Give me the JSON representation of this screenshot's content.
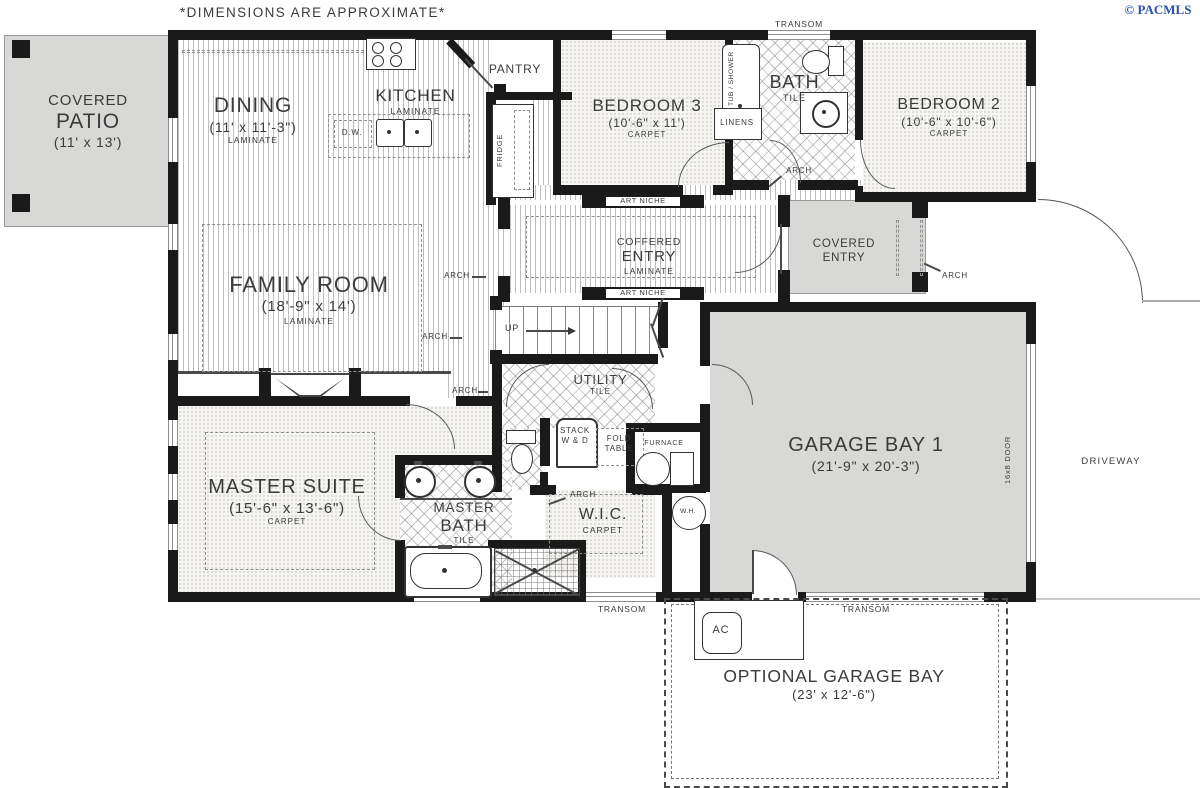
{
  "plan": {
    "disclaimer": "*DIMENSIONS ARE APPROXIMATE*",
    "copyright": "© PACMLS",
    "accent_blue": "#2d4fae",
    "rooms": {
      "covered_patio": {
        "line1": "COVERED",
        "line2": "PATIO",
        "dims": "(11' x 13')"
      },
      "dining": {
        "name": "DINING",
        "dims": "(11' x 11'-3\")",
        "floor": "LAMINATE"
      },
      "kitchen": {
        "name": "KITCHEN",
        "floor": "LAMINATE"
      },
      "pantry": {
        "name": "PANTRY"
      },
      "bedroom3": {
        "name": "BEDROOM 3",
        "dims": "(10'-6\" x 11')",
        "floor": "CARPET"
      },
      "bath": {
        "name": "BATH",
        "floor": "TILE"
      },
      "bedroom2": {
        "name": "BEDROOM 2",
        "dims": "(10'-6\" x 10'-6\")",
        "floor": "CARPET"
      },
      "coffered_entry": {
        "line1": "COFFERED",
        "line2": "ENTRY",
        "floor": "LAMINATE"
      },
      "covered_entry": {
        "line1": "COVERED",
        "line2": "ENTRY"
      },
      "family_room": {
        "name": "FAMILY ROOM",
        "dims": "(18'-9\" x 14')",
        "floor": "LAMINATE"
      },
      "utility": {
        "name": "UTILITY",
        "floor": "TILE"
      },
      "garage_bay1": {
        "name": "GARAGE BAY 1",
        "dims": "(21'-9\" x 20'-3\")"
      },
      "master_suite": {
        "name": "MASTER SUITE",
        "dims": "(15'-6\" x 13'-6\")",
        "floor": "CARPET"
      },
      "master_bath": {
        "line1": "MASTER",
        "line2": "BATH",
        "floor": "TILE"
      },
      "wic": {
        "name": "W.I.C.",
        "floor": "CARPET"
      },
      "optional_garage": {
        "name": "OPTIONAL GARAGE BAY",
        "dims": "(23' x 12'-6\")"
      }
    },
    "labels": {
      "transom": "TRANSOM",
      "art_niche": "ART NICHE",
      "linens": "LINENS",
      "tub_shower": "TUB / SHOWER",
      "fridge": "FRIDGE",
      "dw": "D.W.",
      "stack_line1": "STACK",
      "stack_line2": "W & D",
      "fold_line1": "FOLD",
      "fold_line2": "TABLE",
      "furnace": "FURNACE",
      "wh": "W.H.",
      "ac": "AC",
      "up": "UP",
      "arch": "ARCH",
      "driveway": "DRIVEWAY",
      "garage_door": "16x8 DOOR"
    }
  }
}
